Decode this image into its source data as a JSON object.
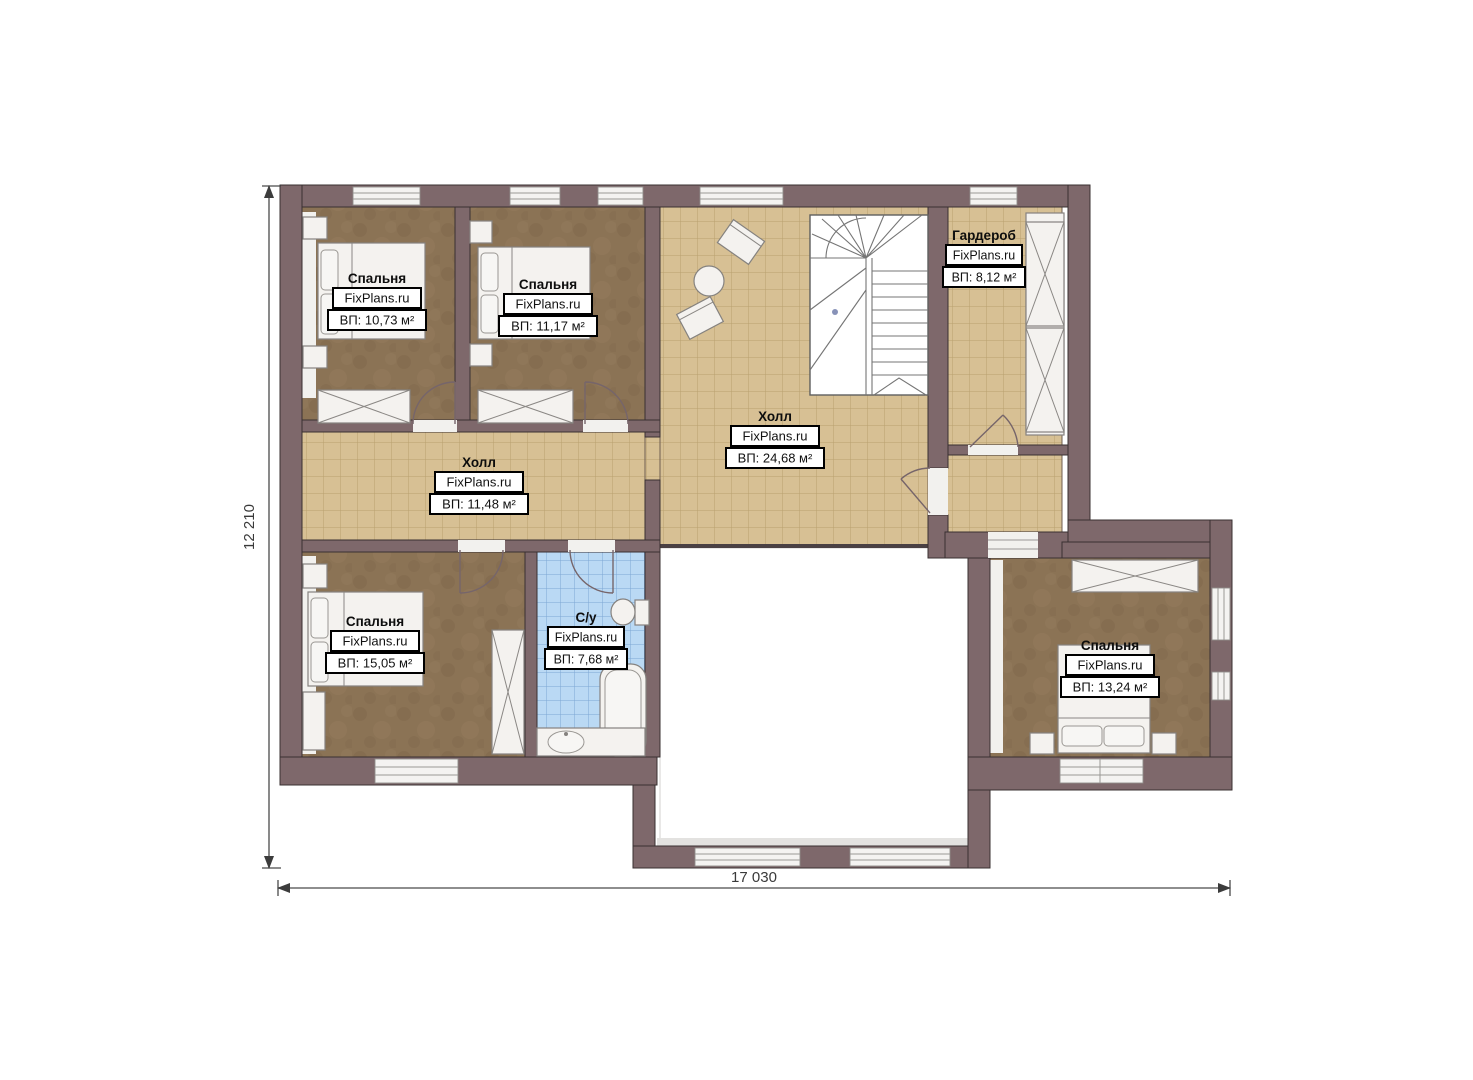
{
  "plan": {
    "brand": "FixPlans.ru",
    "rooms": [
      {
        "id": "bedroom-1",
        "name": "Спальня",
        "area": "ВП: 10,73 м²"
      },
      {
        "id": "bedroom-2",
        "name": "Спальня",
        "area": "ВП: 11,17 м²"
      },
      {
        "id": "wardrobe",
        "name": "Гардероб",
        "area": "ВП: 8,12 м²"
      },
      {
        "id": "hall-main",
        "name": "Холл",
        "area": "ВП: 24,68 м²"
      },
      {
        "id": "hall-corridor",
        "name": "Холл",
        "area": "ВП: 11,48 м²"
      },
      {
        "id": "bedroom-3",
        "name": "Спальня",
        "area": "ВП: 15,05 м²"
      },
      {
        "id": "bathroom",
        "name": "С/у",
        "area": "ВП: 7,68 м²"
      },
      {
        "id": "bedroom-4",
        "name": "Спальня",
        "area": "ВП: 13,24 м²"
      }
    ],
    "dimensions": {
      "width_label": "17 030",
      "height_label": "12 210"
    },
    "colors": {
      "wall": "#7e686b",
      "floor_tile": "#d7c094",
      "carpet": "#8b7355",
      "bath_tile": "#bad9f4",
      "background": "#ffffff"
    },
    "furniture_icons": [
      "bed-icon",
      "wardrobe-icon",
      "stairs-icon",
      "round-table-icon",
      "chair-icon",
      "toilet-icon",
      "bathtub-icon",
      "sink-icon"
    ]
  }
}
